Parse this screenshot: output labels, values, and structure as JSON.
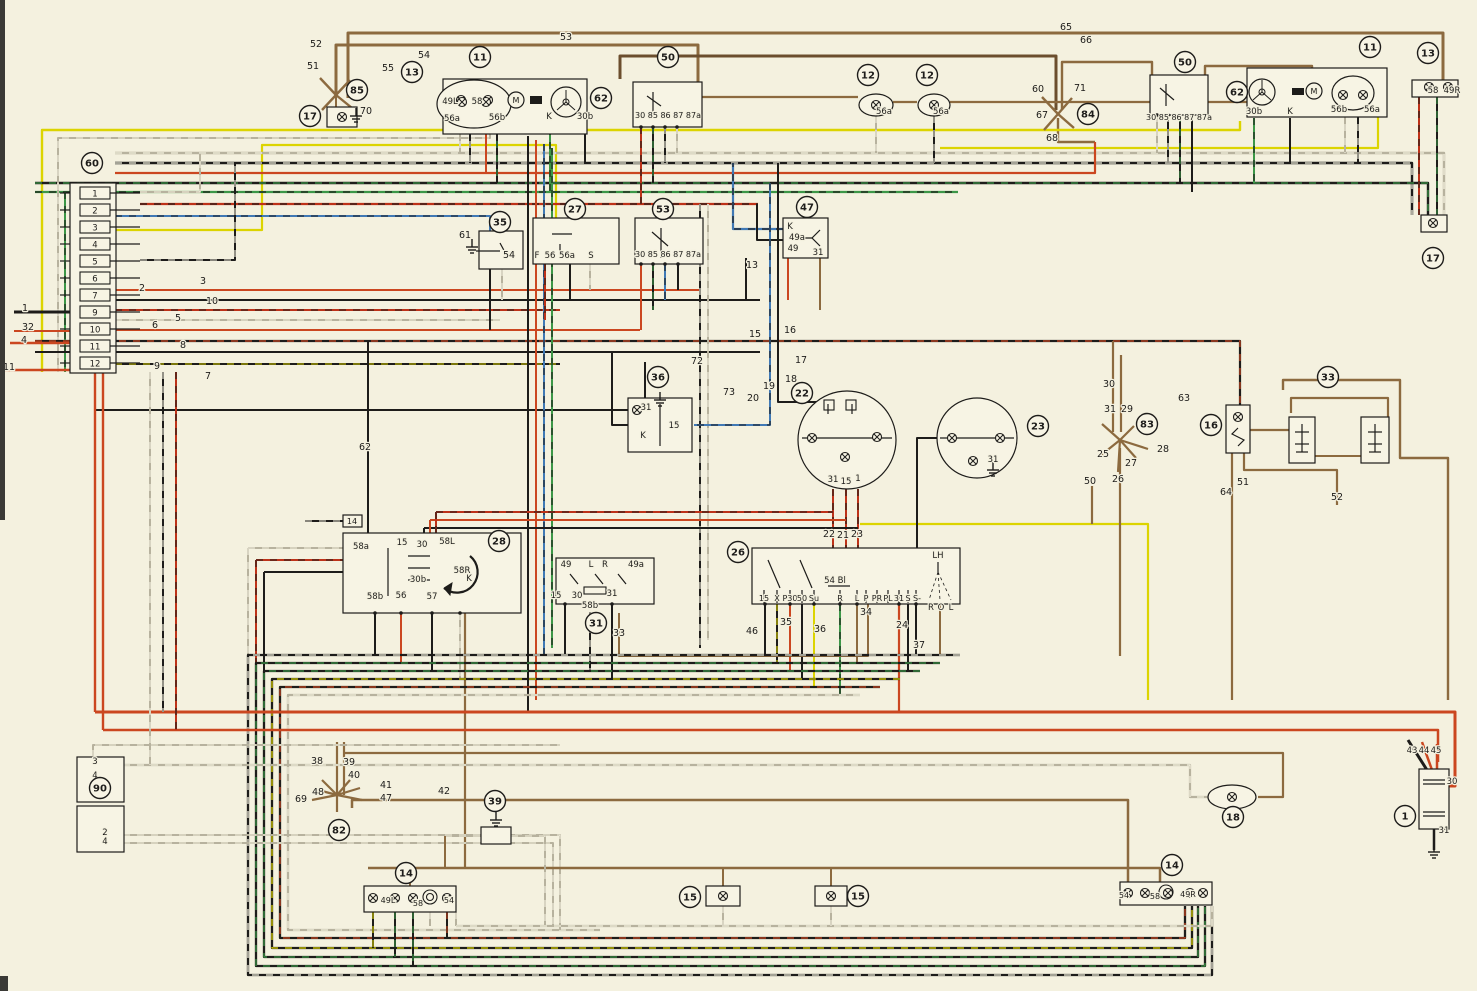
{
  "meta": {
    "description": "Automotive wiring diagram (color-coded wires, numbered components)"
  },
  "palette": {
    "paper": "#f4f1df",
    "box_fill": "#f7f4e4",
    "ink": "#1d1c1a",
    "red": "#cb4720",
    "red2": "#bd3218",
    "brown": "#8c6a3f",
    "darkbrown": "#6b4e2e",
    "yellow": "#dcd400",
    "green": "#3c9747",
    "blue": "#4079b5",
    "gray": "#b7b29e",
    "white": "#f4f1df",
    "edge": "#3a3a36"
  },
  "components": [
    [
      "60",
      92,
      163,
      "fuse-box"
    ],
    [
      "85",
      357,
      90,
      "junction"
    ],
    [
      "17",
      310,
      116,
      "side-marker-lamp-left"
    ],
    [
      "13",
      412,
      72,
      "front-turn-signal-left"
    ],
    [
      "11",
      480,
      57,
      "headlamp-left"
    ],
    [
      "62",
      601,
      98,
      "headlamp-unit-left"
    ],
    [
      "50",
      668,
      57,
      "relay-left"
    ],
    [
      "12",
      868,
      75,
      "horn"
    ],
    [
      "12",
      927,
      75,
      "horn"
    ],
    [
      "84",
      1088,
      114,
      "junction"
    ],
    [
      "50",
      1185,
      62,
      "relay-right"
    ],
    [
      "62",
      1237,
      92,
      "headlamp-unit-right"
    ],
    [
      "11",
      1370,
      47,
      "headlamp-right"
    ],
    [
      "13",
      1428,
      53,
      "front-turn-signal-right"
    ],
    [
      "17",
      1433,
      258,
      "side-marker-lamp-right"
    ],
    [
      "35",
      500,
      222,
      "switch"
    ],
    [
      "27",
      575,
      209,
      "relay"
    ],
    [
      "53",
      663,
      209,
      "relay"
    ],
    [
      "47",
      807,
      207,
      "flasher-relay"
    ],
    [
      "36",
      658,
      377,
      "switch"
    ],
    [
      "22",
      802,
      393,
      "instrument-cluster"
    ],
    [
      "23",
      1038,
      426,
      "gauge"
    ],
    [
      "83",
      1147,
      424,
      "junction"
    ],
    [
      "16",
      1211,
      425,
      "interior-lamp"
    ],
    [
      "33",
      1328,
      377,
      "door-switches"
    ],
    [
      "28",
      499,
      541,
      "ignition-starter-switch"
    ],
    [
      "31",
      596,
      623,
      "turn-signal-switch"
    ],
    [
      "26",
      738,
      552,
      "steering-column-switch"
    ],
    [
      "90",
      100,
      788,
      "connector"
    ],
    [
      "82",
      339,
      830,
      "junction"
    ],
    [
      "39",
      495,
      801,
      "switch"
    ],
    [
      "14",
      406,
      873,
      "tail-lamp-left"
    ],
    [
      "15",
      690,
      897,
      "license-plate-lamp"
    ],
    [
      "15",
      858,
      896,
      "license-plate-lamp"
    ],
    [
      "18",
      1233,
      817,
      "interior-lamp"
    ],
    [
      "1",
      1405,
      816,
      "battery"
    ],
    [
      "14",
      1172,
      865,
      "tail-lamp-right"
    ]
  ],
  "fuses": [
    "1",
    "2",
    "3",
    "4",
    "5",
    "6",
    "7",
    "9",
    "10",
    "11",
    "12"
  ],
  "labels": [
    [
      "52",
      316,
      47
    ],
    [
      "51",
      313,
      69
    ],
    [
      "55",
      388,
      71
    ],
    [
      "54",
      424,
      58
    ],
    [
      "53",
      566,
      40
    ],
    [
      "70",
      366,
      114
    ],
    [
      "49L",
      450,
      104,
      8.5
    ],
    [
      "58",
      477,
      104,
      8.5
    ],
    [
      "56a",
      452,
      121,
      8.5
    ],
    [
      "56b",
      497,
      120,
      8.5
    ],
    [
      "K",
      549,
      119,
      8.5
    ],
    [
      "30b",
      585,
      119,
      8.5
    ],
    [
      "M",
      516,
      103,
      8
    ],
    [
      "30 85 86 87 87a",
      668,
      118,
      8
    ],
    [
      "56a",
      884,
      114,
      8.5
    ],
    [
      "56a",
      941,
      114,
      8.5
    ],
    [
      "65",
      1066,
      30
    ],
    [
      "66",
      1086,
      43
    ],
    [
      "60",
      1038,
      92
    ],
    [
      "71",
      1080,
      91
    ],
    [
      "67",
      1042,
      118
    ],
    [
      "68",
      1052,
      141
    ],
    [
      "30 85 86 87 87a",
      1179,
      120,
      8
    ],
    [
      "30b",
      1254,
      114,
      8.5
    ],
    [
      "K",
      1290,
      114,
      8.5
    ],
    [
      "M",
      1314,
      94,
      8
    ],
    [
      "56b",
      1339,
      112,
      8.5
    ],
    [
      "56a",
      1372,
      112,
      8.5
    ],
    [
      "58",
      1433,
      93,
      8.5
    ],
    [
      "49R",
      1452,
      93,
      8.5
    ],
    [
      "61",
      465,
      238
    ],
    [
      "54",
      509,
      258
    ],
    [
      "F",
      537,
      258,
      8.5
    ],
    [
      "56",
      550,
      258,
      8.5
    ],
    [
      "56a",
      567,
      258,
      8.5
    ],
    [
      "S",
      591,
      258,
      8.5
    ],
    [
      "30 85 86 87 87a",
      668,
      257,
      8
    ],
    [
      "K",
      790,
      229,
      8.5
    ],
    [
      "49a",
      797,
      240,
      8.5
    ],
    [
      "49",
      793,
      251,
      8.5
    ],
    [
      "31",
      818,
      255,
      8.5
    ],
    [
      "13",
      752,
      268
    ],
    [
      "72",
      697,
      364
    ],
    [
      "73",
      729,
      395
    ],
    [
      "15",
      755,
      337
    ],
    [
      "16",
      790,
      333
    ],
    [
      "17",
      801,
      363
    ],
    [
      "18",
      791,
      382
    ],
    [
      "19",
      769,
      389
    ],
    [
      "20",
      753,
      401
    ],
    [
      "31",
      646,
      410,
      8.5
    ],
    [
      "15",
      674,
      428,
      8.5
    ],
    [
      "K",
      643,
      438,
      8.5
    ],
    [
      "31",
      833,
      482,
      8.5
    ],
    [
      "15",
      846,
      484,
      8.5
    ],
    [
      "1",
      858,
      481,
      8.5
    ],
    [
      "22",
      829,
      537
    ],
    [
      "21",
      843,
      538
    ],
    [
      "23",
      857,
      537
    ],
    [
      "31",
      993,
      462,
      8.5
    ],
    [
      "30",
      1109,
      387
    ],
    [
      "31",
      1110,
      412
    ],
    [
      "29",
      1127,
      412
    ],
    [
      "25",
      1103,
      457
    ],
    [
      "27",
      1131,
      466
    ],
    [
      "26",
      1118,
      482
    ],
    [
      "50",
      1090,
      484
    ],
    [
      "28",
      1163,
      452
    ],
    [
      "63",
      1184,
      401
    ],
    [
      "64",
      1226,
      495
    ],
    [
      "51",
      1243,
      485
    ],
    [
      "52",
      1337,
      500
    ],
    [
      "62",
      365,
      450
    ],
    [
      "14",
      352,
      524,
      8
    ],
    [
      "58a",
      361,
      549,
      8.5
    ],
    [
      "15",
      402,
      545,
      8.5
    ],
    [
      "30",
      422,
      547,
      8.5
    ],
    [
      "58L",
      447,
      544,
      8.5
    ],
    [
      "30b",
      418,
      582,
      8.5
    ],
    [
      "58R",
      462,
      573,
      8.5
    ],
    [
      "K",
      469,
      581,
      8.5
    ],
    [
      "58b",
      375,
      599,
      8.5
    ],
    [
      "56",
      401,
      598,
      8.5
    ],
    [
      "57",
      432,
      599,
      8.5
    ],
    [
      "49",
      566,
      567,
      8.5
    ],
    [
      "L",
      591,
      567,
      8.5
    ],
    [
      "R",
      605,
      567,
      8.5
    ],
    [
      "49a",
      636,
      567,
      8.5
    ],
    [
      "15",
      556,
      598,
      8.5
    ],
    [
      "30",
      577,
      598,
      8.5
    ],
    [
      "31",
      612,
      596,
      8.5
    ],
    [
      "58b",
      590,
      608,
      8.5
    ],
    [
      "33",
      619,
      636
    ],
    [
      "LH",
      938,
      558,
      8.5
    ],
    [
      "54 Bl",
      835,
      583,
      8.5
    ],
    [
      "15",
      764,
      601,
      8
    ],
    [
      "X",
      777,
      601,
      8
    ],
    [
      "P30",
      790,
      601,
      8
    ],
    [
      "50",
      802,
      601,
      8
    ],
    [
      "Su",
      814,
      601,
      8
    ],
    [
      "R",
      840,
      601,
      8
    ],
    [
      "L",
      857,
      601,
      8
    ],
    [
      "P",
      866,
      601,
      8
    ],
    [
      "PR",
      877,
      601,
      8
    ],
    [
      "PL",
      888,
      601,
      8
    ],
    [
      "31",
      899,
      601,
      8
    ],
    [
      "S",
      908,
      601,
      8
    ],
    [
      "S-",
      917,
      601,
      8
    ],
    [
      "R",
      931,
      610,
      8.5
    ],
    [
      "O",
      941,
      610,
      8.5
    ],
    [
      "L",
      951,
      610,
      8.5
    ],
    [
      "46",
      752,
      634
    ],
    [
      "35",
      786,
      625
    ],
    [
      "36",
      820,
      632
    ],
    [
      "34",
      866,
      615
    ],
    [
      "24",
      902,
      628
    ],
    [
      "37",
      919,
      648
    ],
    [
      "3",
      95,
      764,
      8.5
    ],
    [
      "4",
      95,
      778,
      8.5
    ],
    [
      "2",
      105,
      835,
      8.5
    ],
    [
      "4",
      105,
      844,
      8.5
    ],
    [
      "38",
      317,
      764
    ],
    [
      "39",
      349,
      765
    ],
    [
      "40",
      354,
      778
    ],
    [
      "41",
      386,
      788
    ],
    [
      "47",
      386,
      801
    ],
    [
      "48",
      318,
      795
    ],
    [
      "69",
      301,
      802
    ],
    [
      "42",
      444,
      794
    ],
    [
      "49L",
      388,
      903,
      8
    ],
    [
      "58",
      418,
      906,
      8
    ],
    [
      "54",
      449,
      903,
      8
    ],
    [
      "43",
      1412,
      753,
      8.5
    ],
    [
      "44",
      1424,
      753,
      8.5
    ],
    [
      "45",
      1436,
      753,
      8.5
    ],
    [
      "30",
      1452,
      784,
      8.5
    ],
    [
      "31",
      1444,
      833,
      8.5
    ],
    [
      "54",
      1124,
      898,
      8
    ],
    [
      "58",
      1155,
      899,
      8
    ],
    [
      "49R",
      1188,
      897,
      8
    ],
    [
      "1",
      25,
      311
    ],
    [
      "32",
      28,
      330
    ],
    [
      "4",
      24,
      343
    ],
    [
      "11",
      9,
      370
    ],
    [
      "2",
      142,
      291
    ],
    [
      "3",
      203,
      284
    ],
    [
      "10",
      212,
      304
    ],
    [
      "5",
      178,
      321
    ],
    [
      "6",
      155,
      328
    ],
    [
      "8",
      183,
      348
    ],
    [
      "9",
      157,
      369
    ],
    [
      "7",
      208,
      379
    ]
  ]
}
